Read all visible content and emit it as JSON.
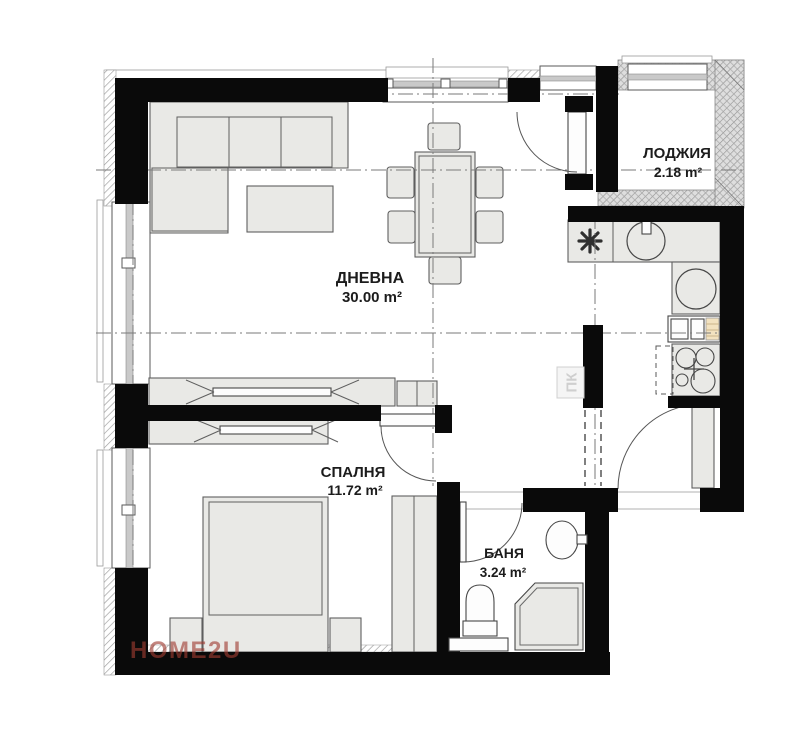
{
  "plan": {
    "rooms": {
      "living": {
        "name": "ДНЕВНА",
        "area": "30.00 m²"
      },
      "bedroom": {
        "name": "СПАЛНЯ",
        "area": "11.72 m²"
      },
      "bathroom": {
        "name": "БАНЯ",
        "area": "3.24 m²"
      },
      "loggia": {
        "name": "ЛОДЖИЯ",
        "area": "2.18 m²"
      }
    },
    "watermarks": {
      "brand": "HOME2U",
      "logo": "ПК"
    },
    "colors": {
      "wall": "#0a0a0a",
      "furniture_fill": "#e9e9e6",
      "glazing_gray": "#c9c9c9",
      "watermark_red": "#a03c32",
      "appliance_accent": "#f2e2c0"
    }
  }
}
